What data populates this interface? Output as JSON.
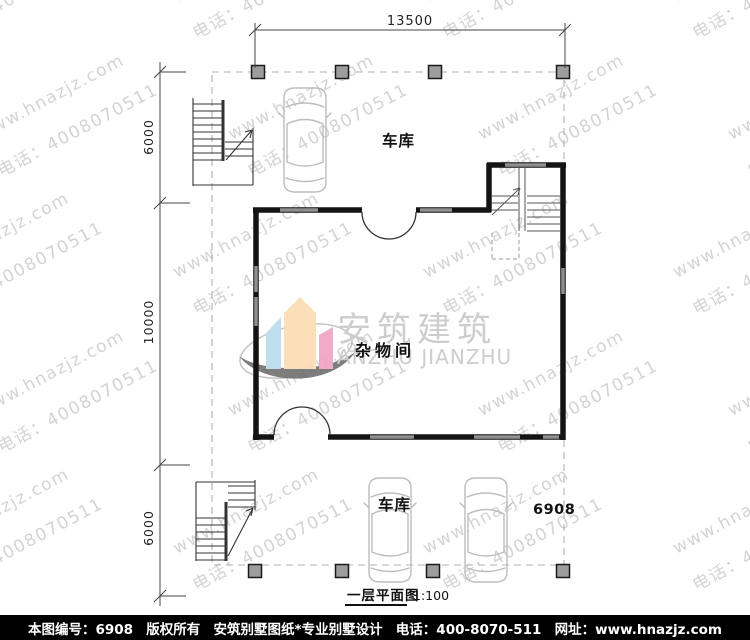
{
  "watermark": {
    "line1": "www.hnazjz.com",
    "line2": "电话：4008070511"
  },
  "dimensions": {
    "top_width": "13500",
    "left_top": "6000",
    "left_middle": "10000",
    "left_bottom": "6000"
  },
  "labels": {
    "garage_top": "车库",
    "garage_bottom": "车库",
    "storage_room": "杂物间",
    "sheet_number": "6908"
  },
  "plan_title": {
    "name": "一层平面图",
    "scale": "1:100"
  },
  "logo": {
    "chinese": "安筑建筑",
    "english": "ANZHU JIANZHU"
  },
  "footer": {
    "sheet_no": "本图编号：6908",
    "copyright": "版权所有",
    "studio": "安筑别墅图纸*专业别墅设计",
    "phone": "电话：400-8070-511",
    "website": "网址：www.hnazjz.com"
  },
  "colors": {
    "logo_blue": "#badbe9",
    "logo_peach": "#fbdcb1",
    "logo_pink": "#efa3c4",
    "swoosh_gray": "#6f6f6f",
    "logo_text_gray": "#c8c8c8",
    "wall_black": "#141414",
    "window_gray": "#8f8f8f",
    "column_gray": "#9d9d9d",
    "boundary_gray": "#b0b0b0",
    "footer_bg": "#000000"
  }
}
